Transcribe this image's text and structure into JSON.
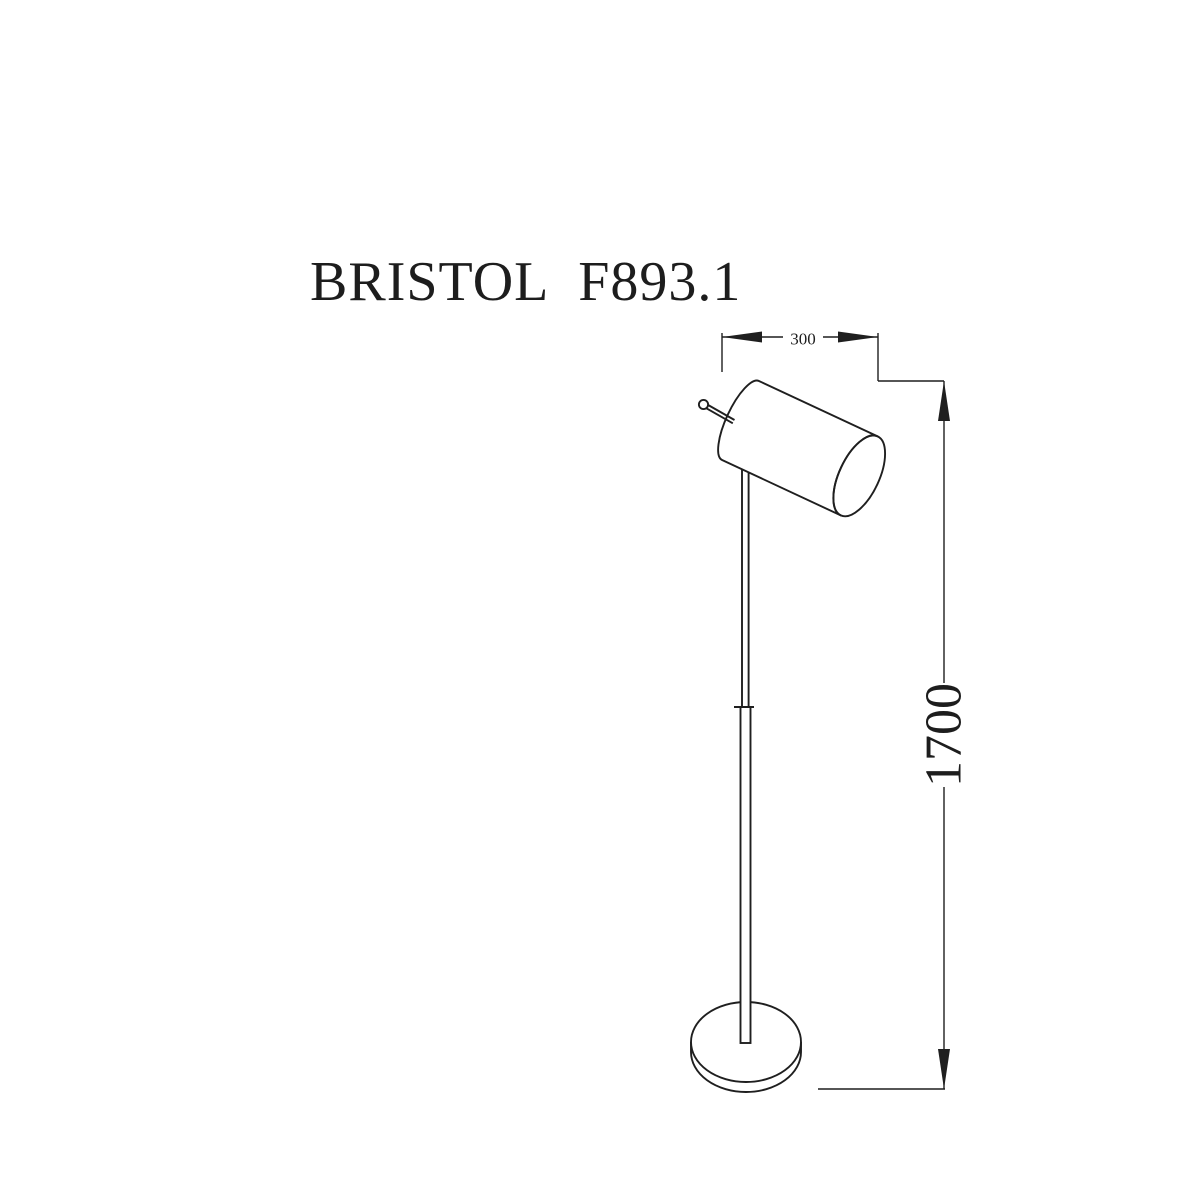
{
  "page": {
    "background_color": "#ffffff",
    "line_color": "#1f1f1f"
  },
  "title": {
    "text": "BRISTOL F893.1"
  },
  "drawing": {
    "subject": "floor-lamp-line-drawing",
    "dimensions": {
      "width": {
        "value": "300",
        "orientation": "horizontal"
      },
      "height": {
        "value": "1700",
        "orientation": "vertical"
      }
    }
  }
}
